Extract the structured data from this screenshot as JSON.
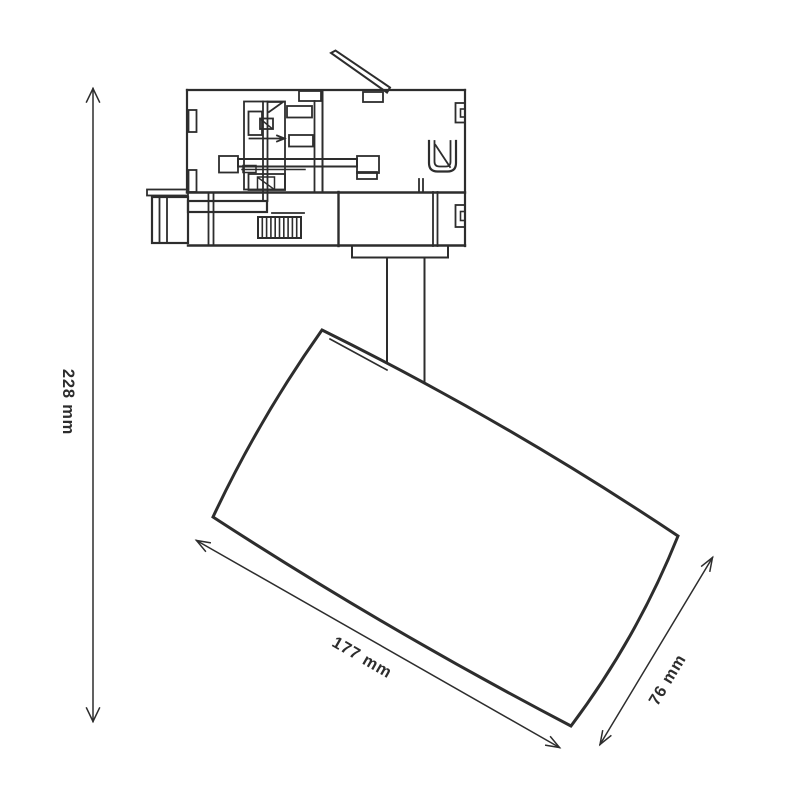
{
  "page": {
    "background_color": "#ffffff",
    "line_color": "#2d2d2d"
  },
  "diagram": {
    "subject": "track-spotlight-dimension-drawing",
    "labels": {
      "height": "228 mm",
      "length": "177 mm",
      "diameter": "76 mm"
    }
  }
}
